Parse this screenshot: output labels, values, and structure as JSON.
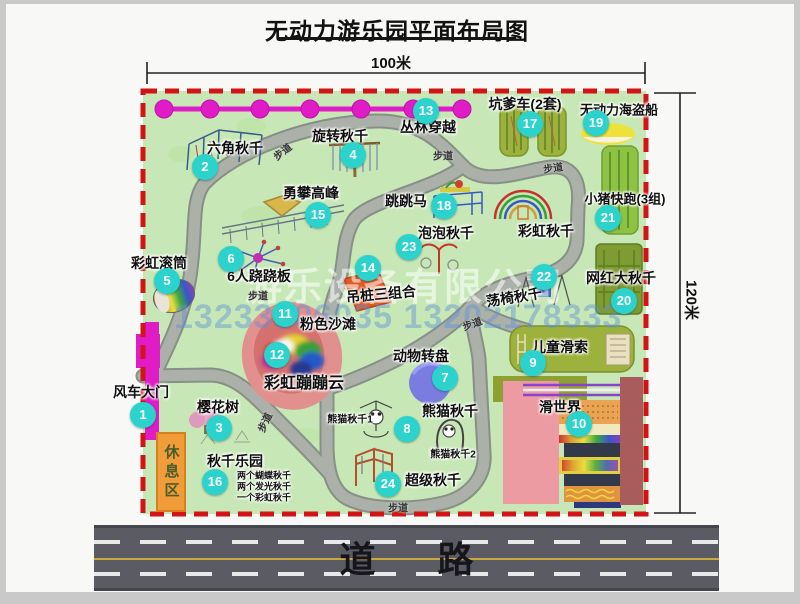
{
  "page": {
    "title": "无动力游乐园平面布局图",
    "width_dimension": "100米",
    "height_dimension": "120米",
    "road_label": "道  路",
    "rest_area_label": "休息区",
    "walkway_label": "步道",
    "watermark_company": "游乐设备有限公司",
    "watermark_phone": "13233806035 13202178333"
  },
  "colors": {
    "map_bg": "#c7e8b6",
    "boundary": "#d21414",
    "badge": "#2bd3cc",
    "magenta": "#e01cc6",
    "path_edge": "#878f87",
    "path_fill": "#abb1a9",
    "road": "#5b5b63",
    "road_yellow": "#c9a83e",
    "olive": "#9db23c",
    "green_bright": "#8fc244",
    "swing_green": "#7f9c33",
    "pink_beach": "#e2908e",
    "pink_beach_inner": "#d4716f",
    "rest_orange": "#f09c38",
    "turntable_purple": "#7b7ce0",
    "boat_yellow": "#eee23a",
    "slide_pink": "#ec9ba3",
    "slide_maroon": "#a85c5c"
  },
  "attractions": [
    {
      "num": "1",
      "name": "风车大门",
      "badge": [
        137,
        411
      ],
      "label": [
        135,
        388
      ]
    },
    {
      "num": "2",
      "name": "六角秋千",
      "badge": [
        199,
        163
      ],
      "label": [
        229,
        144
      ]
    },
    {
      "num": "3",
      "name": "樱花树",
      "badge": [
        213,
        424
      ],
      "label": [
        212,
        403
      ]
    },
    {
      "num": "4",
      "name": "旋转秋千",
      "badge": [
        347,
        151
      ],
      "label": [
        334,
        132
      ]
    },
    {
      "num": "5",
      "name": "彩虹滚筒",
      "badge": [
        161,
        277
      ],
      "label": [
        153,
        259
      ]
    },
    {
      "num": "6",
      "name": "6人跷跷板",
      "badge": [
        225,
        255
      ],
      "label": [
        253,
        272
      ]
    },
    {
      "num": "7",
      "name": "动物转盘",
      "badge": [
        439,
        374
      ],
      "label": [
        415,
        352
      ]
    },
    {
      "num": "8",
      "name": "熊猫秋千",
      "badge": [
        401,
        425
      ],
      "label": [
        444,
        407
      ]
    },
    {
      "num": "9",
      "name": "儿童滑索",
      "badge": [
        527,
        359
      ],
      "label": [
        554,
        343
      ]
    },
    {
      "num": "10",
      "name": "滑世界",
      "badge": [
        573,
        420
      ],
      "label": [
        554,
        403
      ]
    },
    {
      "num": "11",
      "name": "粉色沙滩",
      "badge": [
        279,
        310
      ],
      "label": [
        322,
        320
      ]
    },
    {
      "num": "12",
      "name": "彩虹蹦蹦云",
      "badge": [
        271,
        351
      ],
      "label": [
        298,
        377
      ],
      "size": 16
    },
    {
      "num": "13",
      "name": "丛林穿越",
      "badge": [
        420,
        107
      ],
      "label": [
        422,
        123
      ]
    },
    {
      "num": "14",
      "name": "吊桩三组合",
      "badge": [
        362,
        264
      ],
      "label": [
        375,
        290
      ],
      "rot": -5
    },
    {
      "num": "15",
      "name": "勇攀高峰",
      "badge": [
        312,
        211
      ],
      "label": [
        305,
        189
      ]
    },
    {
      "num": "16",
      "name": "秋千乐园",
      "badge": [
        209,
        478
      ],
      "label": [
        229,
        457
      ]
    },
    {
      "num": "17",
      "name": "坑爹车(2套)",
      "badge": [
        524,
        120
      ],
      "label": [
        519,
        100
      ]
    },
    {
      "num": "18",
      "name": "跳跳马",
      "badge": [
        438,
        202
      ],
      "label": [
        400,
        197
      ]
    },
    {
      "num": "19",
      "name": "无动力海盗船",
      "badge": [
        590,
        119
      ],
      "label": [
        613,
        105
      ],
      "size": 13
    },
    {
      "num": "20",
      "name": "网红大秋千",
      "badge": [
        618,
        297
      ],
      "label": [
        615,
        274
      ]
    },
    {
      "num": "21",
      "name": "小猪快跑(3组)",
      "badge": [
        602,
        214
      ],
      "label": [
        619,
        194
      ],
      "size": 13
    },
    {
      "num": "22",
      "name": "荡椅秋千",
      "badge": [
        538,
        273
      ],
      "label": [
        508,
        293
      ],
      "rot": -9
    },
    {
      "num": "23",
      "name": "泡泡秋千",
      "badge": [
        403,
        243
      ],
      "label": [
        440,
        229
      ]
    },
    {
      "num": "24",
      "name": "超级秋千",
      "badge": [
        382,
        480
      ],
      "label": [
        427,
        476
      ]
    }
  ],
  "extra_labels": [
    {
      "text": "彩虹秋千",
      "x": 540,
      "y": 227
    },
    {
      "text": "熊猫秋千1",
      "x": 344,
      "y": 414,
      "size": 10
    },
    {
      "text": "熊猫秋千2",
      "x": 447,
      "y": 449,
      "size": 10
    },
    {
      "text": "两个蝴蝶秋千",
      "x": 258,
      "y": 471,
      "size": 9
    },
    {
      "text": "两个发光秋千",
      "x": 258,
      "y": 482,
      "size": 9
    },
    {
      "text": "一个彩虹秋千",
      "x": 258,
      "y": 493,
      "size": 9
    }
  ],
  "walkway_positions": [
    [
      276,
      147,
      -38
    ],
    [
      437,
      151,
      0
    ],
    [
      547,
      163,
      -8
    ],
    [
      252,
      291,
      0
    ],
    [
      466,
      319,
      -20
    ],
    [
      258,
      418,
      -65
    ],
    [
      392,
      503,
      0
    ]
  ]
}
